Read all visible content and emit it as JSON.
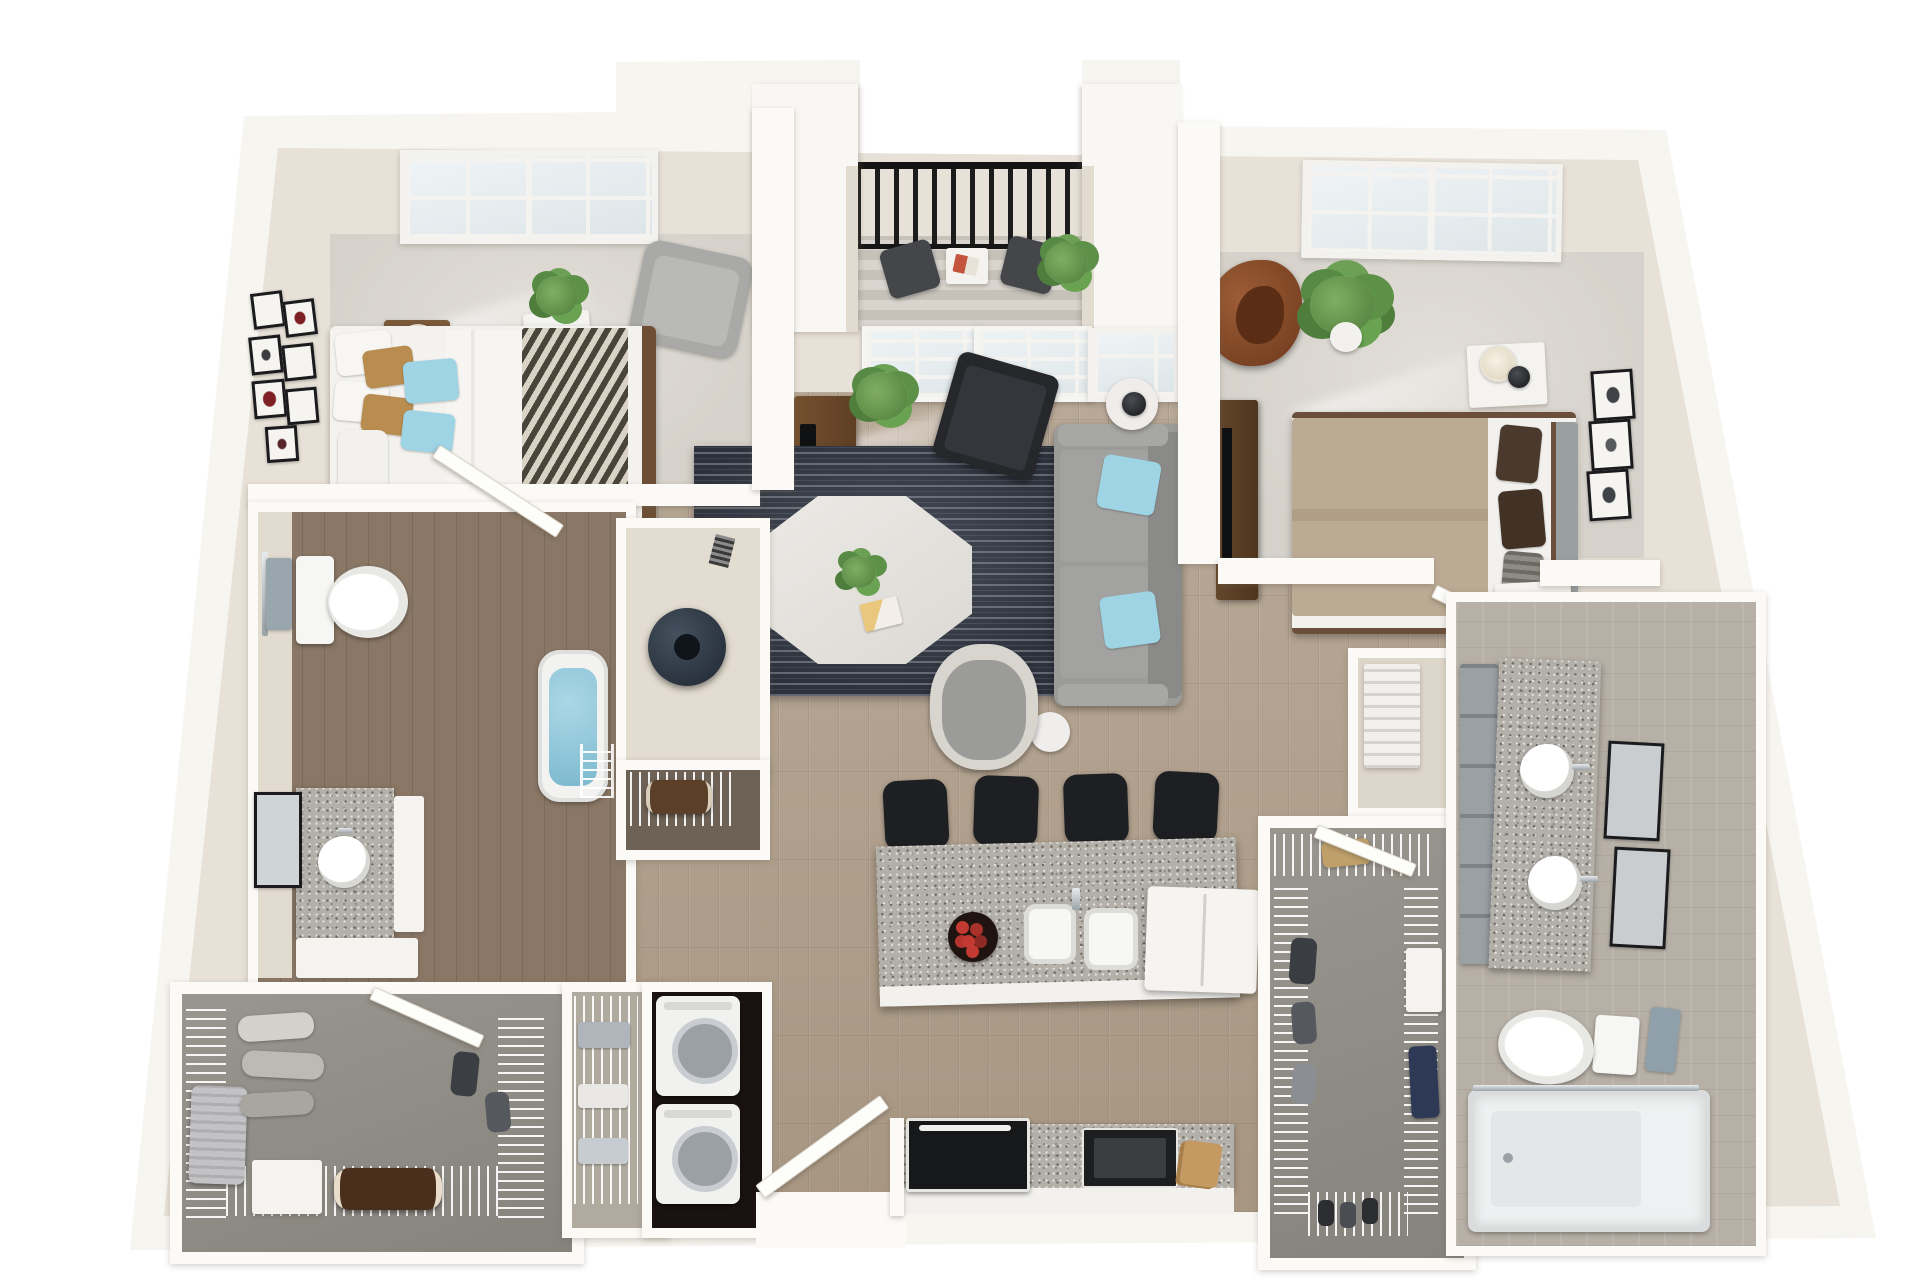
{
  "meta": {
    "title": "2 Bedroom / 2 Bathroom Apartment - 3D Top-Down Floor Plan Render",
    "view": "3d-dollhouse-top-down",
    "background": "#ffffff",
    "text_visible": "none"
  },
  "palette": {
    "outer_wall": "#f7f5f0",
    "wall_face": "#e7e1d7",
    "bedroom_carpet": "#d8d4ce",
    "closet_carpet": "#908c86",
    "main_wood_floor": "#b2a290",
    "bath_dark_wood": "#8a7766",
    "granite": "#b3afa9",
    "area_rug": "#2c313b",
    "accent_pillow_blue": "#9fd4e4",
    "pillow_tan": "#b98d4f",
    "duvet_taupe": "#b4a28b",
    "egg_chair_brown": "#8a4f2d",
    "black_furniture": "#1d1f22",
    "tub_water_blue": "#8fc6db",
    "plant_green": "#5f9150",
    "railing_black": "#141414"
  },
  "rooms": {
    "bedroom1": {
      "name": "Bedroom 1 (top left)",
      "floor": "carpet",
      "furniture": [
        "queen bed with chevron throw and white/tan/blue pillows",
        "wood nightstand with white drum lamp",
        "wood nightstand with cream drum lamp",
        "potted plant in white planter",
        "gray armchair",
        "gallery wall of 7 small frames",
        "double grid window"
      ]
    },
    "balcony": {
      "name": "Balcony",
      "floor": "striped decking",
      "furniture": [
        "black metal railing",
        "bistro table with magazine",
        "two dark patio chairs",
        "potted plant"
      ]
    },
    "livingRoom": {
      "name": "Living Room",
      "floor": "wood",
      "furniture": [
        "french patio doors",
        "sidelight window",
        "wood tv console with tv",
        "palm plant",
        "charcoal striped area rug",
        "octagonal white marble coffee table with plant and magazine",
        "black accent chair",
        "gray sofa with two light-blue pillows",
        "gray barrel accent chair",
        "round side table with black sphere lamp",
        "small round end table"
      ]
    },
    "bedroom2": {
      "name": "Bedroom 2 (top right)",
      "floor": "carpet",
      "furniture": [
        "bed with taupe duvet and brown/striped pillows",
        "gray upholstered headboard",
        "white nightstand with black sphere lamp (north)",
        "white nightstand with black sphere lamp (south)",
        "dark wood dresser with tv",
        "brown leather egg chair",
        "monstera plant in white pot",
        "double grid window",
        "three black-framed artworks"
      ]
    },
    "bathroom1": {
      "name": "Bathroom 1",
      "floor": "dark wood",
      "furniture": [
        "toilet",
        "towel bar with gray towel",
        "interior swing door",
        "soaking tub filled with water",
        "granite vanity with round sink",
        "black framed mirror",
        "white storage cabinet",
        "wire rack"
      ]
    },
    "waterHeaterCloset": {
      "name": "Water Heater Closet",
      "furniture": [
        "water heater tank"
      ]
    },
    "storageCubby": {
      "name": "Storage Cubby",
      "furniture": [
        "wire shelf",
        "brown duffel bag"
      ]
    },
    "kitchen": {
      "name": "Kitchen",
      "floor": "wood",
      "furniture": [
        "granite island with white cabinet base",
        "four black bar stools",
        "double sink with chrome faucet",
        "bowl of red apples",
        "white refrigerator",
        "granite rear counter",
        "black range",
        "black microwave appliance",
        "wood cutting boards"
      ]
    },
    "entry": {
      "name": "Entry",
      "furniture": [
        "white entry door (open)"
      ]
    },
    "laundryCloset": {
      "name": "Laundry Closet",
      "furniture": [
        "stacked washer",
        "stacked dryer"
      ]
    },
    "linenCloset": {
      "name": "Linen Closet",
      "furniture": [
        "wire shelving",
        "folded towels"
      ]
    },
    "walkInCloset1": {
      "name": "Walk-in Closet 1 (bottom left)",
      "floor": "gray carpet",
      "furniture": [
        "wire shelving",
        "hanging clothes",
        "silver suitcase",
        "brown duffel bag",
        "white storage bench",
        "white drawer unit",
        "closet door"
      ]
    },
    "walkInCloset2": {
      "name": "Walk-in Closet 2 (bottom right)",
      "floor": "gray carpet",
      "furniture": [
        "wire shelving",
        "hanging clothes",
        "blue jeans",
        "white drawer unit",
        "tan tote bag",
        "shoes",
        "closet door"
      ]
    },
    "mechanicalCloset": {
      "name": "Mechanical Closet",
      "furniture": [
        "hvac air handler unit"
      ]
    },
    "bathroom2": {
      "name": "Bathroom 2",
      "floor": "tile",
      "furniture": [
        "double granite vanity with gray cabinets",
        "two round vessel sinks with chrome faucets",
        "two black framed mirrors",
        "toilet",
        "towel ring with gray towel",
        "walk-in shower with glass panel",
        "interior swing door"
      ]
    },
    "hallway": {
      "name": "Hallways",
      "floor": "wood",
      "furniture": []
    }
  }
}
